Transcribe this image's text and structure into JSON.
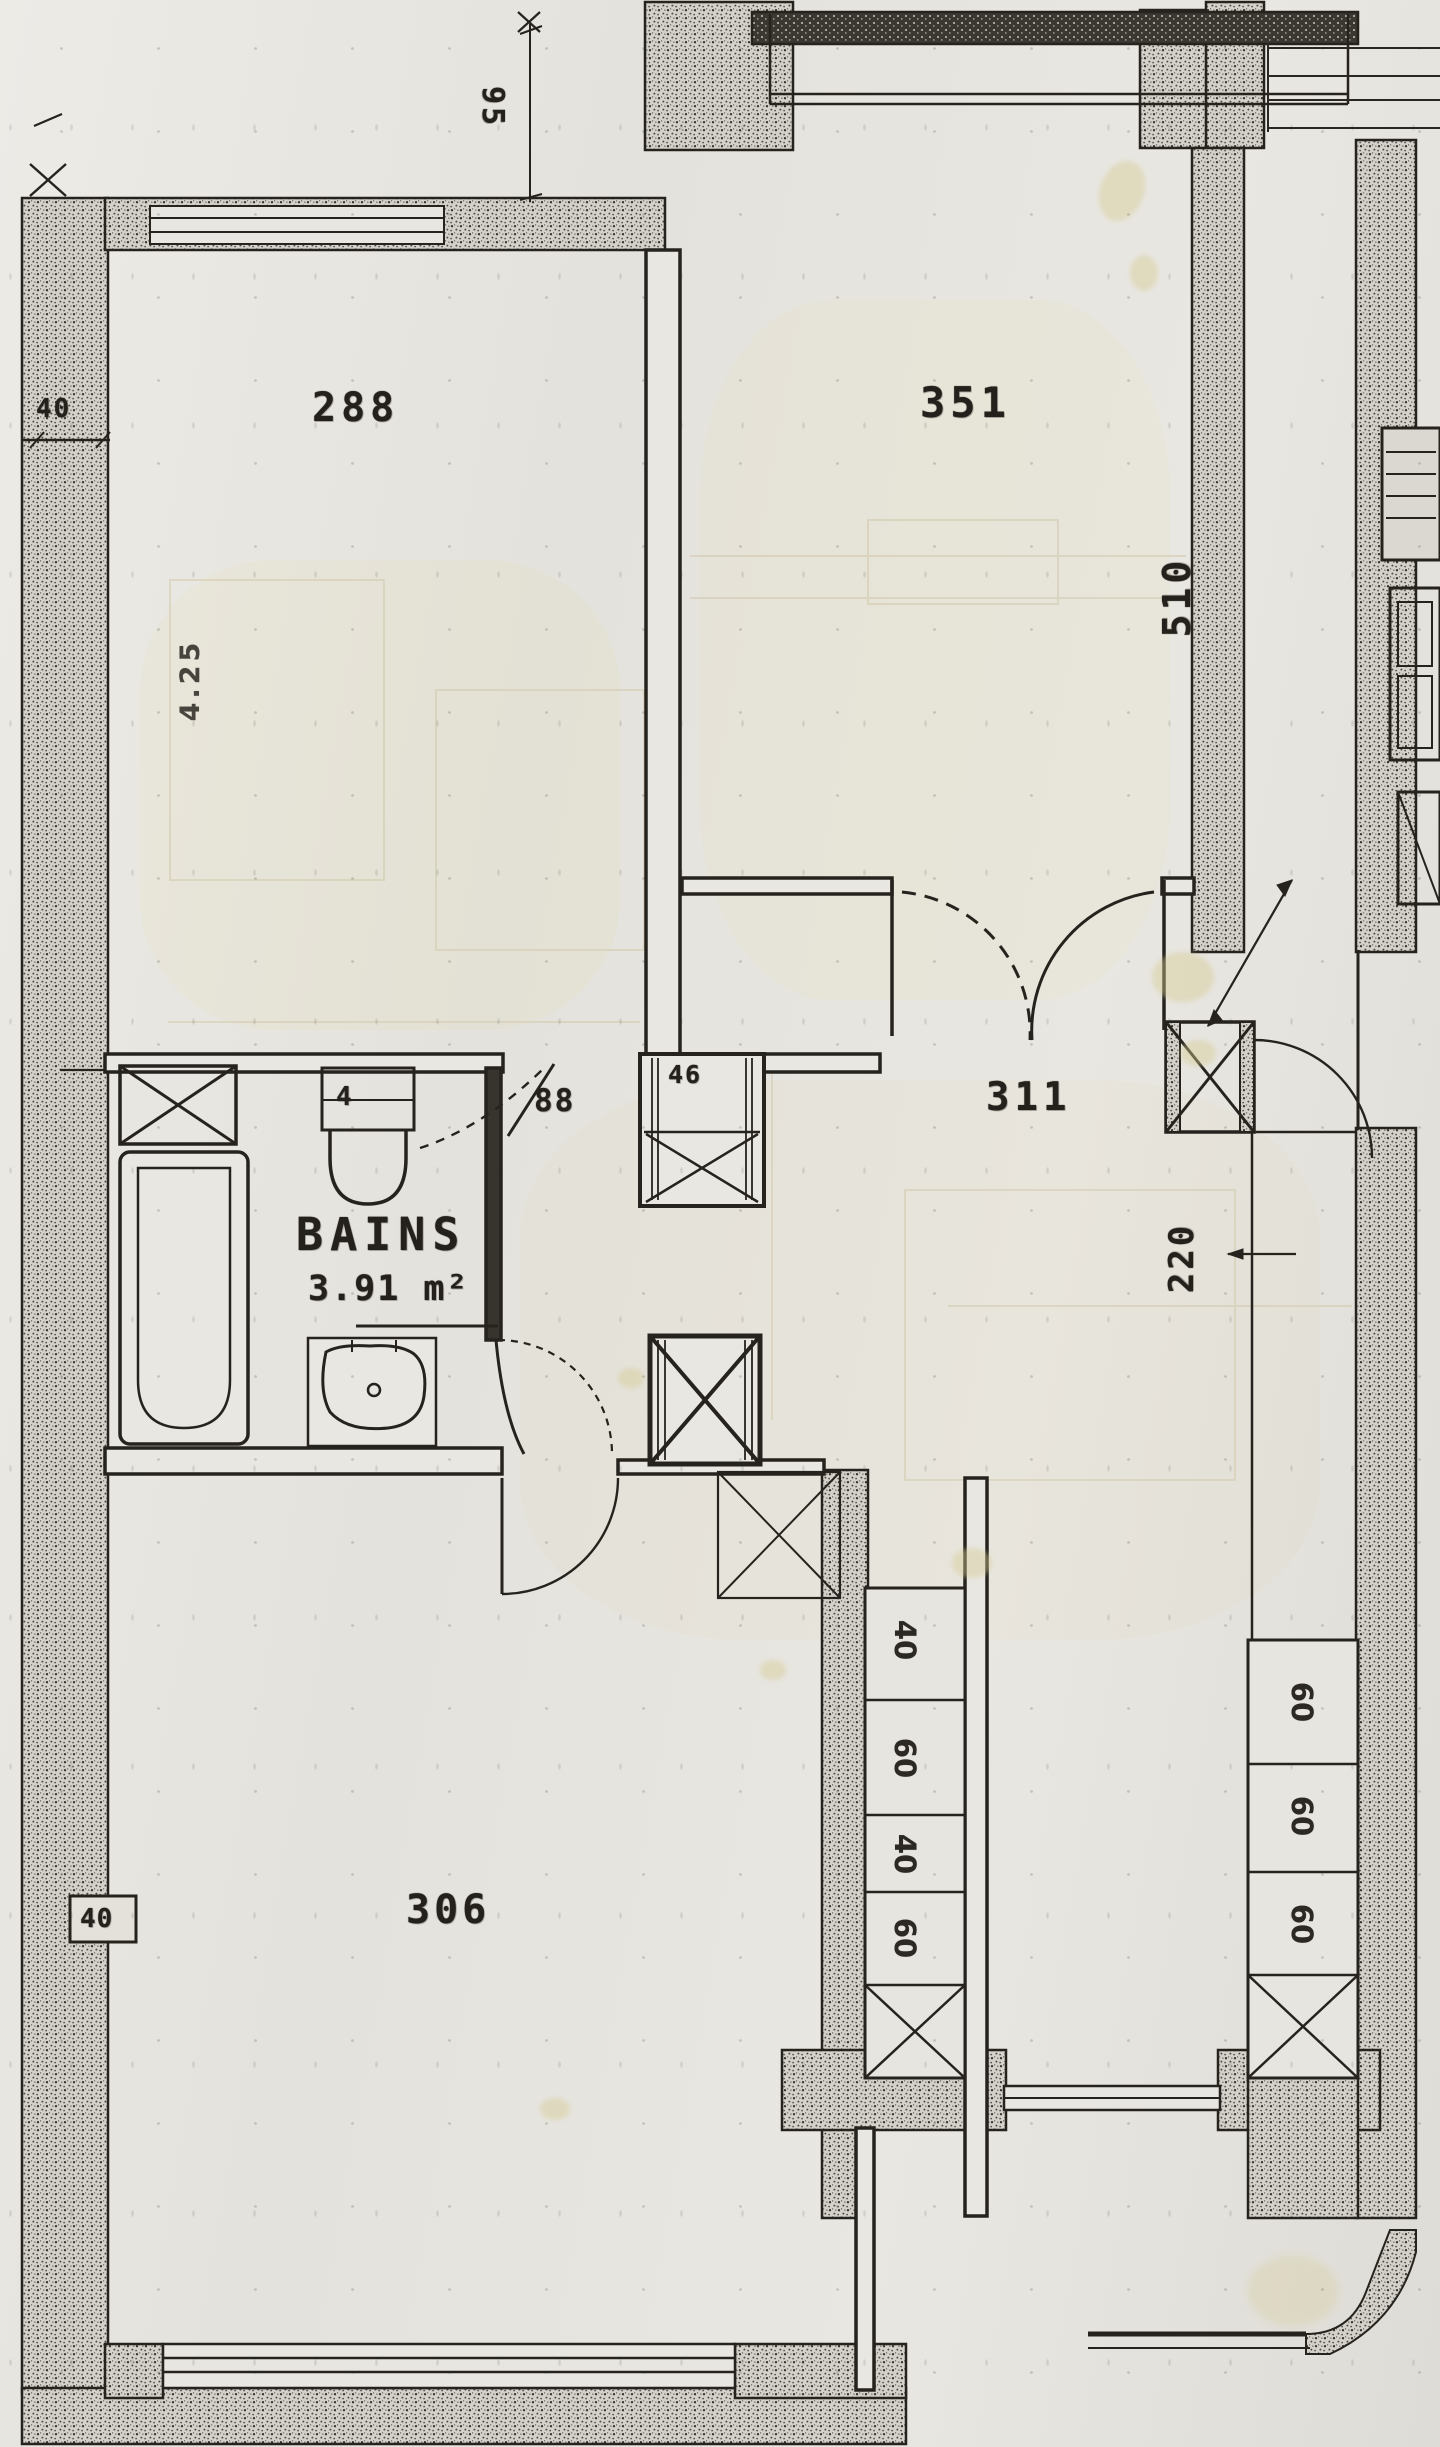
{
  "plan": {
    "rooms": {
      "room_288": "288",
      "room_351": "351",
      "hall_311": "311",
      "room_306": "306",
      "bathroom_name": "BAINS",
      "bathroom_area": "3.91 m²"
    },
    "dimensions": {
      "recess_height": "95",
      "wall_thickness_top": "40",
      "room_288_width": "4.25",
      "room_351_length": "510",
      "bath_door_width": "88",
      "duct_size": "46",
      "door_width_220": "220",
      "wall_thickness_left": "40",
      "toilet_mark": "4"
    },
    "closets": {
      "center_cells": [
        "40",
        "60",
        "40",
        "60"
      ],
      "right_cells": [
        "60",
        "60",
        "60"
      ]
    },
    "colors": {
      "paper": "#e6e4df",
      "ink": "#26231e",
      "wall_speckle": "#d4d1ca",
      "stain": "#d5cb92"
    }
  }
}
